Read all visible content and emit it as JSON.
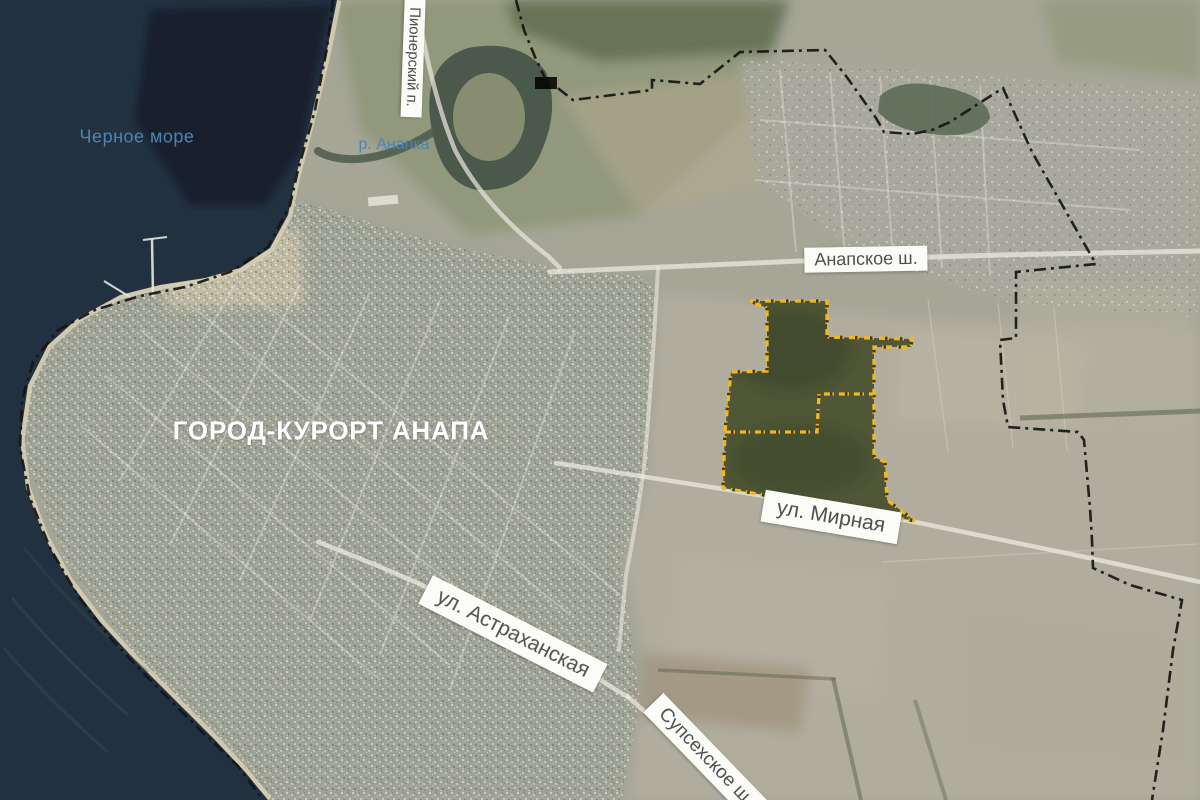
{
  "labels": {
    "sea": "Черное море",
    "river": "р. Анапка",
    "city": "ГОРОД-КУРОРТ АНАПА",
    "road_pionersky": "Пионерский п.",
    "road_anapskoe": "Анапское ш.",
    "road_mirnaya": "ул. Мирная",
    "road_astrakhanskaya": "ул. Астраханская",
    "road_supsekhskoe": "Супсехское ш."
  },
  "colors": {
    "sea": "#223140",
    "land": "#a6a697",
    "plot_fill": "#414b28",
    "plot_border": "#f4b81d",
    "admin_boundary": "#151515",
    "water_label_text": "#4e83b5",
    "road_label_text": "#4f4f4f",
    "road_label_bg": "#fbfbf8",
    "city_label_text": "#ffffff"
  }
}
